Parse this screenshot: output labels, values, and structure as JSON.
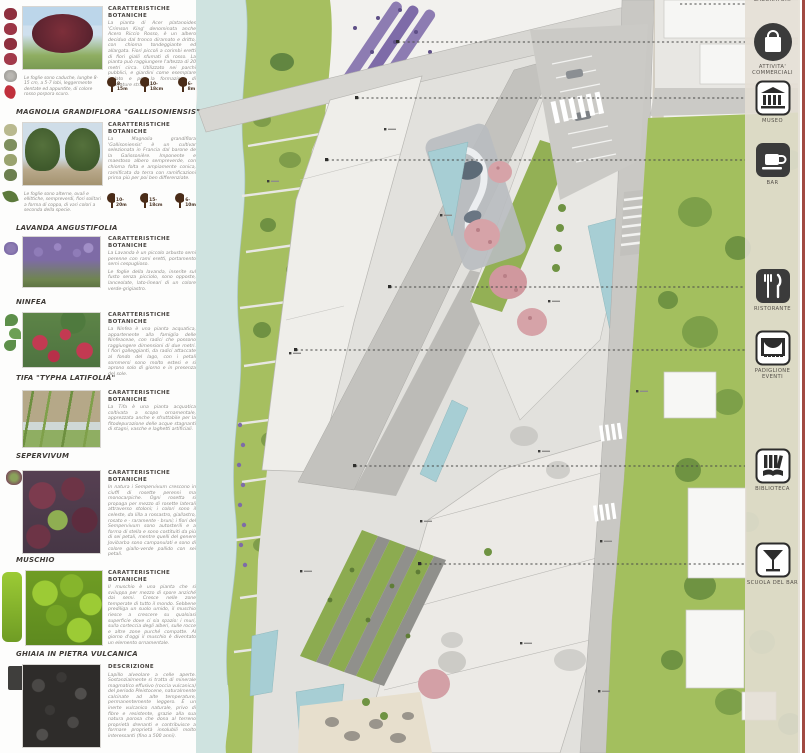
{
  "panel": {
    "sections": [
      {
        "header": "CARATTERISTICHE BOTANICHE",
        "body": "La pianta di Acer platanoides 'Crimson King' denominata anche Acero Riccio Rosso, è un albero deciduo dal tronco diramato e dritto, con chioma tondeggiante ed allargata. Fiori piccoli a corimbi eretti di fiori gialli sfumati di rosso. La pianta può raggiungere l'altezza di 20 metri circa. Utilizzato nei parchi pubblici, e giardini come esemplare isolato e per la formazione di alberature stradali.",
        "caption": "Le foglie sono caduche, lunghe 8-15 cm, a 5-7 lobi, leggermente dentate ed appuntite, di colore rosso porpora scuro.",
        "sizes": [
          "8-15m",
          "10-18cm",
          "6-8m"
        ]
      },
      {
        "title": "MAGNOLIA GRANDIFLORA \"GALLISONIENSIS\"",
        "header": "CARATTERISTICHE BOTANICHE",
        "body": "La Magnolia grandiflora 'Gallisoniensis' è un cultivar selezionata in Francia dal barone de la Galissonière. Imponente e maestoso albero sempreverde, con chioma folta e ampiamente conica, ramificata da terra con ramificazioni prima più per poi ben differenziate.",
        "caption": "Le foglie sono alterne, ovali e ellittiche, sempreverdi, fiori solitari a forma di coppa, di vari colori a seconda della specie.",
        "sizes": [
          "10-20m",
          "15-18cm",
          "6-10m"
        ]
      },
      {
        "title": "LAVANDA ANGUSTIFOLIA",
        "header": "CARATTERISTICHE BOTANICHE",
        "body": "La Lavanda è un piccolo arbusto semi perenne con rami eretti, portamento semi cespuglioso.",
        "body2": "Le foglie della lavanda, inserite sul fusto senza picciolo, sono opposte, lanceolate, lato-lineari di un colore verde-grigiastro."
      },
      {
        "title": "NINFEA",
        "header": "CARATTERISTICHE BOTANICHE",
        "body": "La Ninfea è una pianta acquatica, appartenente alla famiglia delle Ninfeaceae, con radici che possono raggiungere dimensioni di due metri. I fiori galleggianti, da radici attaccate al fondo del lago, con i petali sommersi sono molto estesi e si aprono solo di giorno e in presenza del sole."
      },
      {
        "title": "TIFA \"TYPHA LATIFOLIA\"",
        "header": "CARATTERISTICHE BOTANICHE",
        "body": "La Tifa è una pianta acquatica coltivata a scopo ornamentale, apprezzata anche e sfruttabile per la fitodepurazione delle acque stagnanti di stagni, vasche e laghetti artificiali."
      },
      {
        "title": "SEPERVIVUM",
        "header": "CARATTERISTICHE BOTANICHE",
        "body": "In natura i Sempervivum crescono in ciuffi di rosette perenni ma monocarpiche. Ogni rosetta si propaga per mezzo di rosette laterali attraverso stoloni; i colori sono il celeste, da lilla a rossastro, giallastro, rosato e - raramente - bruni; i fiori del Sempervivum sono autosterili e a forma di stella e sono costituiti da più di sei petali, mentre quelli del genere Jovibarba sono campanulati e sono di colore giallo-verde pallido con sei petali."
      },
      {
        "title": "MUSCHIO",
        "header": "CARATTERISTICHE BOTANICHE",
        "body": "Il muschio è una pianta che si sviluppa per mezzo di spore anziché dai semi. Cresce nelle zone temperate di tutto il mondo. Sebbene prediliga un suolo umido, il muschio riesce a crescere su qualsiasi superficie dove ci sia spazio: i muri, sulla corteccia degli alberi, sulle rocce e altre zone purché compatte. Al giorno d'oggi il muschio è diventato un elemento ornamentale."
      },
      {
        "title": "GHIAIA IN PIETRA VULCANICA",
        "header": "DESCRIZIONE",
        "body": "Lapillo alveolare a celle aperte. Sostanzialmente si tratta di minerale magmatico effusivo (roccia vulcanica) del periodo Pleistocene, naturalmente calcinate ad alte temperature, permanentemente leggero. È un inerte vulcanico naturale, privo di fibre e resistente, grazie alla sua natura porosa che dona al terreno proprietà drenanti e contribuisce a formare proprietà insolubili molto interessanti (fino a 500 anni)."
      }
    ]
  },
  "legend": {
    "top_label": "LABORATORI",
    "items": [
      {
        "icon": "shopping-bag",
        "label": "ATTIVITA' COMMERCIALI"
      },
      {
        "icon": "museum",
        "label": "MUSEO"
      },
      {
        "icon": "coffee-cup",
        "label": "BAR"
      },
      {
        "icon": "fork-knife",
        "label": "RISTORANTE"
      },
      {
        "icon": "stage",
        "label": "PADIGLIONE EVENTI"
      },
      {
        "icon": "books",
        "label": "BIBLIOTECA"
      },
      {
        "icon": "cocktail",
        "label": "SCUOLA DEL BAR"
      }
    ]
  },
  "colors": {
    "river": "#cfe3e0",
    "bank_green": "#a6bf60",
    "lawn": "#a3bf5e",
    "plaza": "#e2e1dd",
    "building_white": "#f0efeb",
    "road": "#c9c8c4",
    "pool": "#a7ced4",
    "lavender": "#8d7cb2",
    "pink_tree": "#d6a3a8",
    "accent_red_line": "#a14a42",
    "legend_bg": "#e4ded4",
    "icon_dark": "#3b3b3b"
  }
}
